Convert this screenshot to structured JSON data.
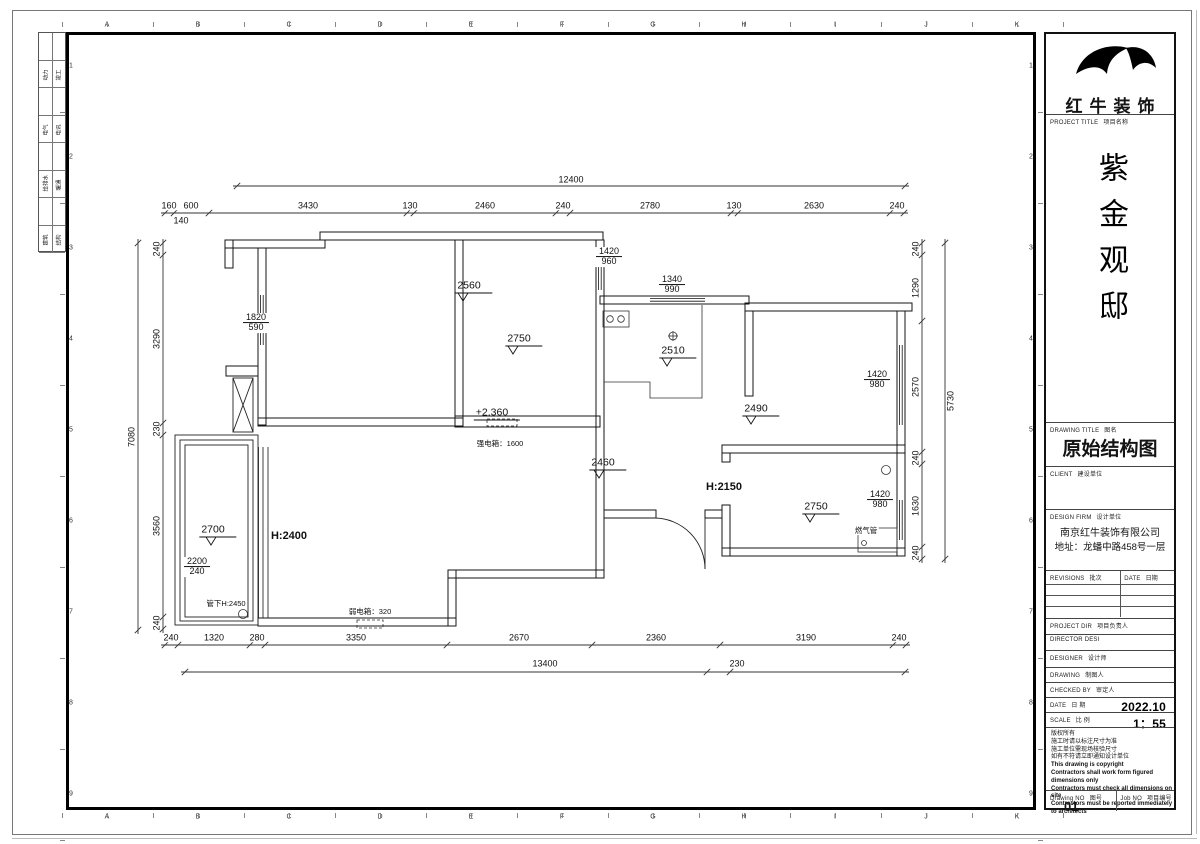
{
  "page": {
    "ruler_letters": [
      "A",
      "B",
      "C",
      "D",
      "E",
      "F",
      "G",
      "H",
      "I",
      "J",
      "K"
    ],
    "ruler_numbers": [
      "1",
      "2",
      "3",
      "4",
      "5",
      "6",
      "7",
      "8",
      "9"
    ],
    "disciplines": [
      {
        "l": "动力",
        "r": "竣工"
      },
      {
        "l": "电气",
        "r": "电讯"
      },
      {
        "l": "给排水",
        "r": "暖通"
      },
      {
        "l": "建筑",
        "r": "结构"
      }
    ],
    "ink": "#141414"
  },
  "title_block": {
    "logo_text": "红牛装饰",
    "project_title_en": "PROJECT TITLE",
    "project_title_cn": "项目名称",
    "project_name": "紫金观邸",
    "drawing_title_en": "DRAWING TITLE",
    "drawing_title_cn": "图名",
    "drawing_title_value": "原始结构图",
    "client_en": "CLIENT",
    "client_cn": "建设单位",
    "design_firm_en": "DESIGN FIRM",
    "design_firm_cn": "设计单位",
    "design_firm_name": "南京红牛装饰有限公司",
    "design_firm_addr": "地址：龙蟠中路458号一层",
    "revisions_en": "REVISIONS",
    "revisions_cn": "批次",
    "rev_date_en": "DATE",
    "rev_date_cn": "日期",
    "fields": [
      {
        "en": "PROJECT DIR",
        "cn": "项目负责人",
        "value": ""
      },
      {
        "en": "DIRECTOR DESI",
        "cn": "",
        "value": ""
      },
      {
        "en": "DESIGNER",
        "cn": "设计师",
        "value": ""
      },
      {
        "en": "DRAWING",
        "cn": "制图人",
        "value": ""
      },
      {
        "en": "CHECKED BY",
        "cn": "审定人",
        "value": ""
      },
      {
        "en": "DATE",
        "cn": "日 期",
        "value": "2022.10"
      },
      {
        "en": "SCALE",
        "cn": "比 例",
        "value": "1：55"
      }
    ],
    "copyright_lines": [
      "版权所有",
      "施工时请以标注尺寸为准",
      "施工单位需现场核验尺寸",
      "如有不符请立即通知设计单位",
      "This drawing is copyright",
      "Contractors shall work form figured dimensions only",
      "Contractors must check all dimensions on site",
      "Contractors must be reported immediately to architects"
    ],
    "drawing_no_en": "Drawing NO",
    "drawing_no_cn": "图号",
    "drawing_no_value": "01",
    "job_no_en": "Job NO",
    "job_no_cn": "项目编号"
  },
  "plan": {
    "dimlines": {
      "h": [
        {
          "y": 186,
          "x": [
            237,
            905
          ]
        },
        {
          "y": 213,
          "x": [
            165,
            174,
            209,
            407,
            414,
            556,
            570,
            731,
            738,
            890,
            904
          ]
        },
        {
          "y": 645,
          "x": [
            165,
            178,
            250,
            265,
            447,
            592,
            720,
            893,
            906
          ]
        },
        {
          "y": 672,
          "x": [
            185,
            707,
            730,
            905
          ]
        }
      ],
      "v": [
        {
          "x": 138,
          "y": [
            243,
            630
          ]
        },
        {
          "x": 163,
          "y": [
            243,
            255,
            423,
            435,
            617,
            629
          ]
        },
        {
          "x": 922,
          "y": [
            243,
            255,
            321,
            452,
            464,
            547,
            559
          ]
        },
        {
          "x": 945,
          "y": [
            243,
            559
          ]
        }
      ]
    },
    "labels": [
      {
        "t": "12400",
        "x": 571,
        "y": 180,
        "c": "d",
        "n": "dim-overall-top"
      },
      {
        "t": "160",
        "x": 169,
        "y": 206,
        "c": "d",
        "n": "dim-top"
      },
      {
        "t": "600",
        "x": 191,
        "y": 206,
        "c": "d",
        "n": "dim-top"
      },
      {
        "t": "3430",
        "x": 308,
        "y": 206,
        "c": "d",
        "n": "dim-top"
      },
      {
        "t": "130",
        "x": 410,
        "y": 206,
        "c": "d",
        "n": "dim-top"
      },
      {
        "t": "2460",
        "x": 485,
        "y": 206,
        "c": "d",
        "n": "dim-top"
      },
      {
        "t": "240",
        "x": 563,
        "y": 206,
        "c": "d",
        "n": "dim-top"
      },
      {
        "t": "2780",
        "x": 650,
        "y": 206,
        "c": "d",
        "n": "dim-top"
      },
      {
        "t": "130",
        "x": 734,
        "y": 206,
        "c": "d",
        "n": "dim-top"
      },
      {
        "t": "2630",
        "x": 814,
        "y": 206,
        "c": "d",
        "n": "dim-top"
      },
      {
        "t": "240",
        "x": 897,
        "y": 206,
        "c": "d",
        "n": "dim-top"
      },
      {
        "t": "140",
        "x": 181,
        "y": 221,
        "c": "d",
        "n": "dim-top"
      },
      {
        "t": "240",
        "x": 171,
        "y": 638,
        "c": "d",
        "n": "dim-bottom"
      },
      {
        "t": "1320",
        "x": 214,
        "y": 638,
        "c": "d",
        "n": "dim-bottom"
      },
      {
        "t": "280",
        "x": 257,
        "y": 638,
        "c": "d",
        "n": "dim-bottom"
      },
      {
        "t": "3350",
        "x": 356,
        "y": 638,
        "c": "d",
        "n": "dim-bottom"
      },
      {
        "t": "2670",
        "x": 519,
        "y": 638,
        "c": "d",
        "n": "dim-bottom"
      },
      {
        "t": "2360",
        "x": 656,
        "y": 638,
        "c": "d",
        "n": "dim-bottom"
      },
      {
        "t": "3190",
        "x": 806,
        "y": 638,
        "c": "d",
        "n": "dim-bottom"
      },
      {
        "t": "240",
        "x": 899,
        "y": 638,
        "c": "d",
        "n": "dim-bottom"
      },
      {
        "t": "13400",
        "x": 545,
        "y": 664,
        "c": "d",
        "n": "dim-overall-bottom"
      },
      {
        "t": "230",
        "x": 737,
        "y": 664,
        "c": "d",
        "n": "dim-bottom"
      },
      {
        "t": "7080",
        "x": 132,
        "y": 437,
        "c": "dv",
        "n": "dim-overall-left"
      },
      {
        "t": "240",
        "x": 157,
        "y": 249,
        "c": "dv",
        "n": "dim-left"
      },
      {
        "t": "3290",
        "x": 157,
        "y": 339,
        "c": "dv",
        "n": "dim-left"
      },
      {
        "t": "230",
        "x": 157,
        "y": 429,
        "c": "dv",
        "n": "dim-left"
      },
      {
        "t": "3560",
        "x": 157,
        "y": 526,
        "c": "dv",
        "n": "dim-left"
      },
      {
        "t": "240",
        "x": 157,
        "y": 623,
        "c": "dv",
        "n": "dim-left"
      },
      {
        "t": "240",
        "x": 916,
        "y": 249,
        "c": "dv",
        "n": "dim-right"
      },
      {
        "t": "1290",
        "x": 916,
        "y": 288,
        "c": "dv",
        "n": "dim-right"
      },
      {
        "t": "2570",
        "x": 916,
        "y": 387,
        "c": "dv",
        "n": "dim-right"
      },
      {
        "t": "240",
        "x": 916,
        "y": 458,
        "c": "dv",
        "n": "dim-right"
      },
      {
        "t": "1630",
        "x": 916,
        "y": 506,
        "c": "dv",
        "n": "dim-right"
      },
      {
        "t": "240",
        "x": 916,
        "y": 553,
        "c": "dv",
        "n": "dim-right"
      },
      {
        "t": "5730",
        "x": 951,
        "y": 401,
        "c": "dv",
        "n": "dim-overall-right"
      },
      {
        "t": "2560",
        "x": 474,
        "y": 287,
        "c": "lv",
        "n": "level-label"
      },
      {
        "t": "2750",
        "x": 524,
        "y": 340,
        "c": "lv",
        "n": "level-label"
      },
      {
        "t": "2510",
        "x": 678,
        "y": 352,
        "c": "lv",
        "n": "level-label"
      },
      {
        "t": "2490",
        "x": 761,
        "y": 410,
        "c": "lv",
        "n": "level-label"
      },
      {
        "t": "2750",
        "x": 821,
        "y": 508,
        "c": "lv",
        "n": "level-label"
      },
      {
        "t": "2460",
        "x": 608,
        "y": 464,
        "c": "lv",
        "n": "level-label"
      },
      {
        "t": "2700",
        "x": 218,
        "y": 531,
        "c": "lv",
        "n": "level-label"
      },
      {
        "t": "+2.360",
        "x": 497,
        "y": 414,
        "c": "lv",
        "n": "level-label"
      },
      {
        "t": "1420",
        "b": "960",
        "x": 609,
        "y": 257,
        "c": "f",
        "n": "window-label"
      },
      {
        "t": "1340",
        "b": "990",
        "x": 672,
        "y": 285,
        "c": "f",
        "n": "window-label"
      },
      {
        "t": "1420",
        "b": "980",
        "x": 877,
        "y": 380,
        "c": "f",
        "n": "window-label"
      },
      {
        "t": "1420",
        "b": "980",
        "x": 880,
        "y": 500,
        "c": "f",
        "n": "window-label"
      },
      {
        "t": "1820",
        "b": "590",
        "x": 256,
        "y": 323,
        "c": "f",
        "n": "window-label"
      },
      {
        "t": "2200",
        "b": "240",
        "x": 197,
        "y": 567,
        "c": "f",
        "n": "window-label"
      },
      {
        "t": "H:2400",
        "x": 289,
        "y": 537,
        "c": "h",
        "n": "height-label"
      },
      {
        "t": "H:2150",
        "x": 724,
        "y": 488,
        "c": "h",
        "n": "height-label"
      },
      {
        "t": "强电箱：1600",
        "x": 500,
        "y": 444,
        "c": "t8",
        "n": "strong-electric-box-label"
      },
      {
        "t": "弱电箱：320",
        "x": 370,
        "y": 612,
        "c": "t8",
        "n": "weak-electric-box-label"
      },
      {
        "t": "管下H:2450",
        "x": 226,
        "y": 604,
        "c": "t8",
        "n": "under-pipe-height-label"
      },
      {
        "t": "燃气管",
        "x": 866,
        "y": 531,
        "c": "t8",
        "n": "gas-pipe-label"
      }
    ]
  }
}
